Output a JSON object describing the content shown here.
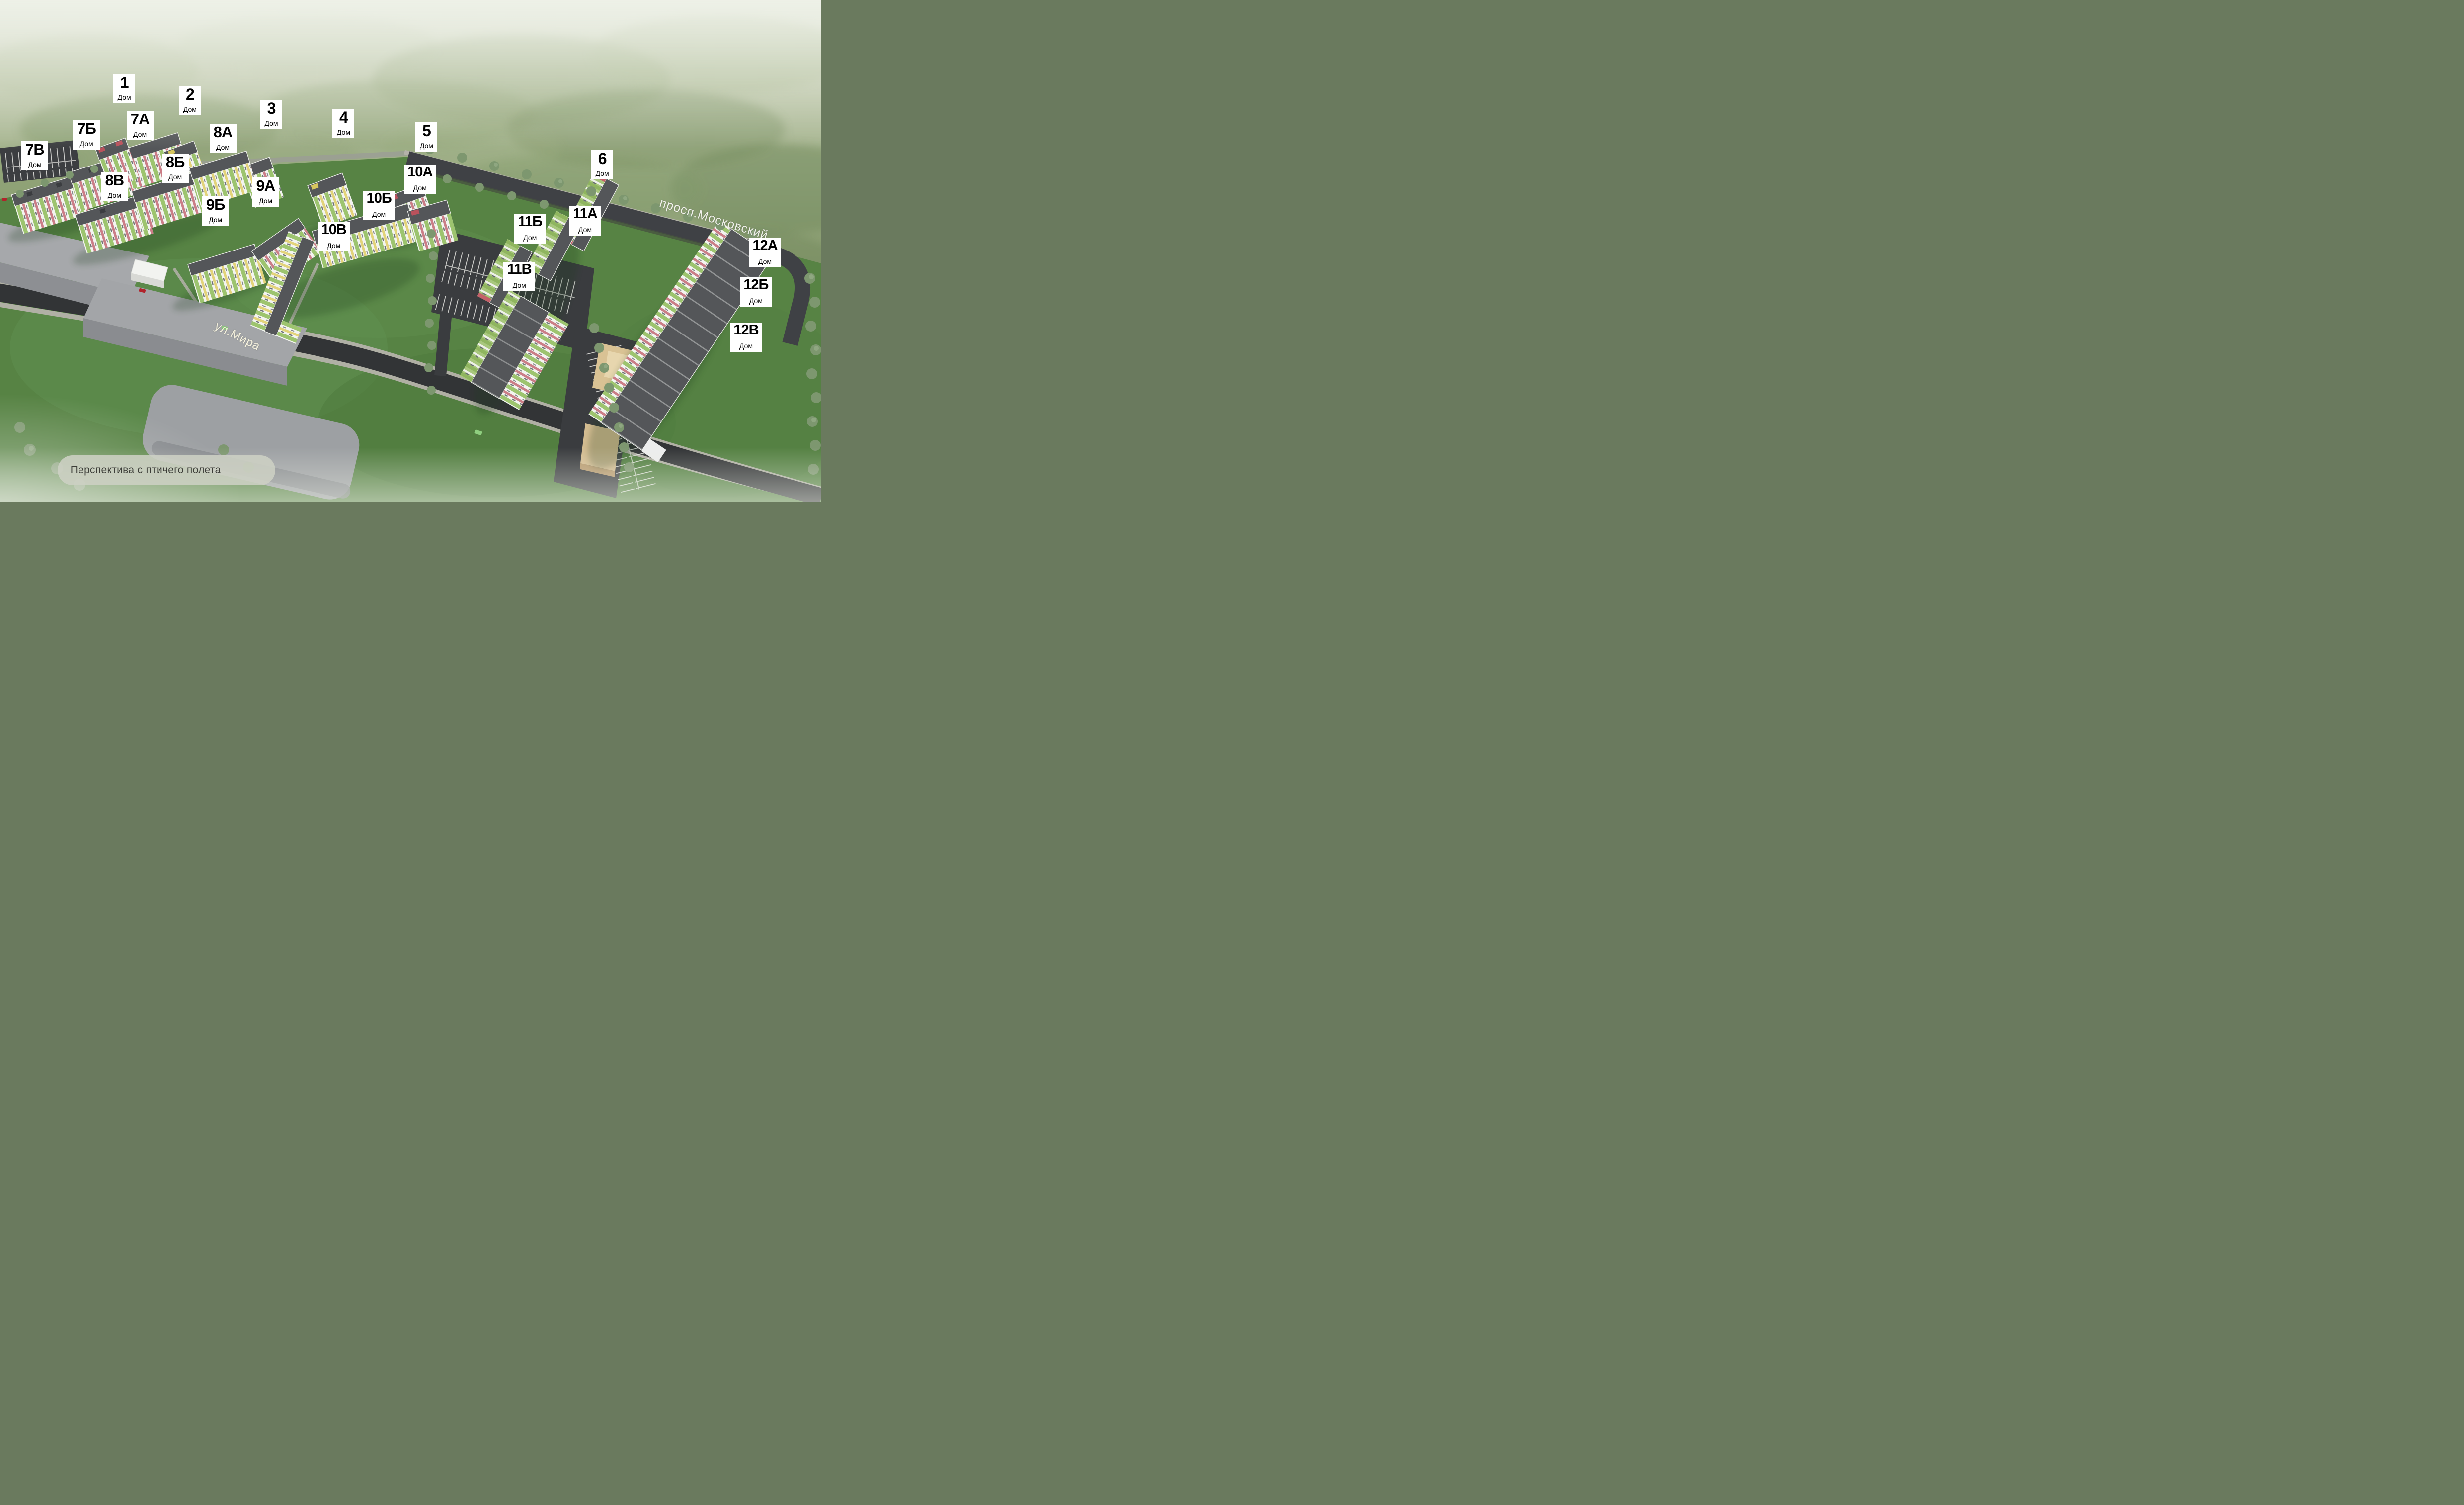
{
  "caption": {
    "text": "Перспектива с птичего полета"
  },
  "streets": {
    "mira": {
      "name": "ул.Мира"
    },
    "moskovsky": {
      "name": "просп.Московский"
    }
  },
  "labels": {
    "house_word": "Дом"
  },
  "buildings": [
    {
      "number": "1",
      "x_pct": 13.8,
      "y_pct": 14.8
    },
    {
      "number": "2",
      "x_pct": 21.8,
      "y_pct": 17.1
    },
    {
      "number": "3",
      "x_pct": 31.7,
      "y_pct": 19.9
    },
    {
      "number": "4",
      "x_pct": 40.5,
      "y_pct": 21.7
    },
    {
      "number": "5",
      "x_pct": 50.6,
      "y_pct": 24.4
    },
    {
      "number": "6",
      "x_pct": 72.0,
      "y_pct": 29.9
    },
    {
      "number": "7А",
      "x_pct": 15.4,
      "y_pct": 22.1
    },
    {
      "number": "7Б",
      "x_pct": 8.9,
      "y_pct": 24.0
    },
    {
      "number": "7В",
      "x_pct": 2.6,
      "y_pct": 28.1
    },
    {
      "number": "8А",
      "x_pct": 25.5,
      "y_pct": 24.7
    },
    {
      "number": "8Б",
      "x_pct": 19.7,
      "y_pct": 30.6
    },
    {
      "number": "8В",
      "x_pct": 12.3,
      "y_pct": 34.3
    },
    {
      "number": "9А",
      "x_pct": 30.7,
      "y_pct": 35.4
    },
    {
      "number": "9Б",
      "x_pct": 24.6,
      "y_pct": 39.1
    },
    {
      "number": "10А",
      "x_pct": 49.2,
      "y_pct": 32.8
    },
    {
      "number": "10Б",
      "x_pct": 44.2,
      "y_pct": 38.1
    },
    {
      "number": "10В",
      "x_pct": 38.7,
      "y_pct": 44.3
    },
    {
      "number": "11А",
      "x_pct": 69.3,
      "y_pct": 41.1
    },
    {
      "number": "11Б",
      "x_pct": 62.6,
      "y_pct": 42.7
    },
    {
      "number": "11В",
      "x_pct": 61.3,
      "y_pct": 52.2
    },
    {
      "number": "12А",
      "x_pct": 91.2,
      "y_pct": 47.5
    },
    {
      "number": "12Б",
      "x_pct": 90.1,
      "y_pct": 55.3
    },
    {
      "number": "12В",
      "x_pct": 88.9,
      "y_pct": 64.3
    }
  ],
  "colors": {
    "facade_green": "#9dc46f",
    "facade_yellow": "#e2d37a",
    "facade_pink": "#cb7e87",
    "roof": "#545659",
    "lawn": "#578344",
    "field": "#93a77e",
    "road": "#333538",
    "label_bg": "#ffffff",
    "label_text": "#000000",
    "street_text": "#f5f1de",
    "caption_bg": "#cdd0c2",
    "caption_text": "#3c3d38"
  }
}
